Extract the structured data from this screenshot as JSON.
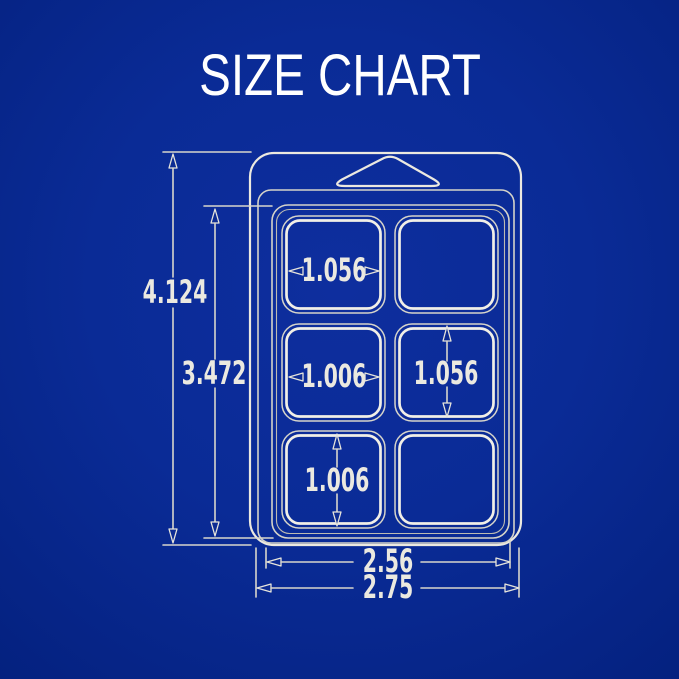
{
  "title": "SIZE CHART",
  "colors": {
    "background": "#0a2b96",
    "line": "#ece9e0",
    "title_text": "#ffffff",
    "dimension_text": "#ebe9e0"
  },
  "dimensions": {
    "overall_height": "4.124",
    "inner_height": "3.472",
    "inner_width": "2.56",
    "overall_width": "2.75",
    "cell_top_left_width": "1.056",
    "cell_middle_left_width": "1.006",
    "cell_middle_right_height": "1.056",
    "cell_bottom_left_height": "1.006"
  }
}
